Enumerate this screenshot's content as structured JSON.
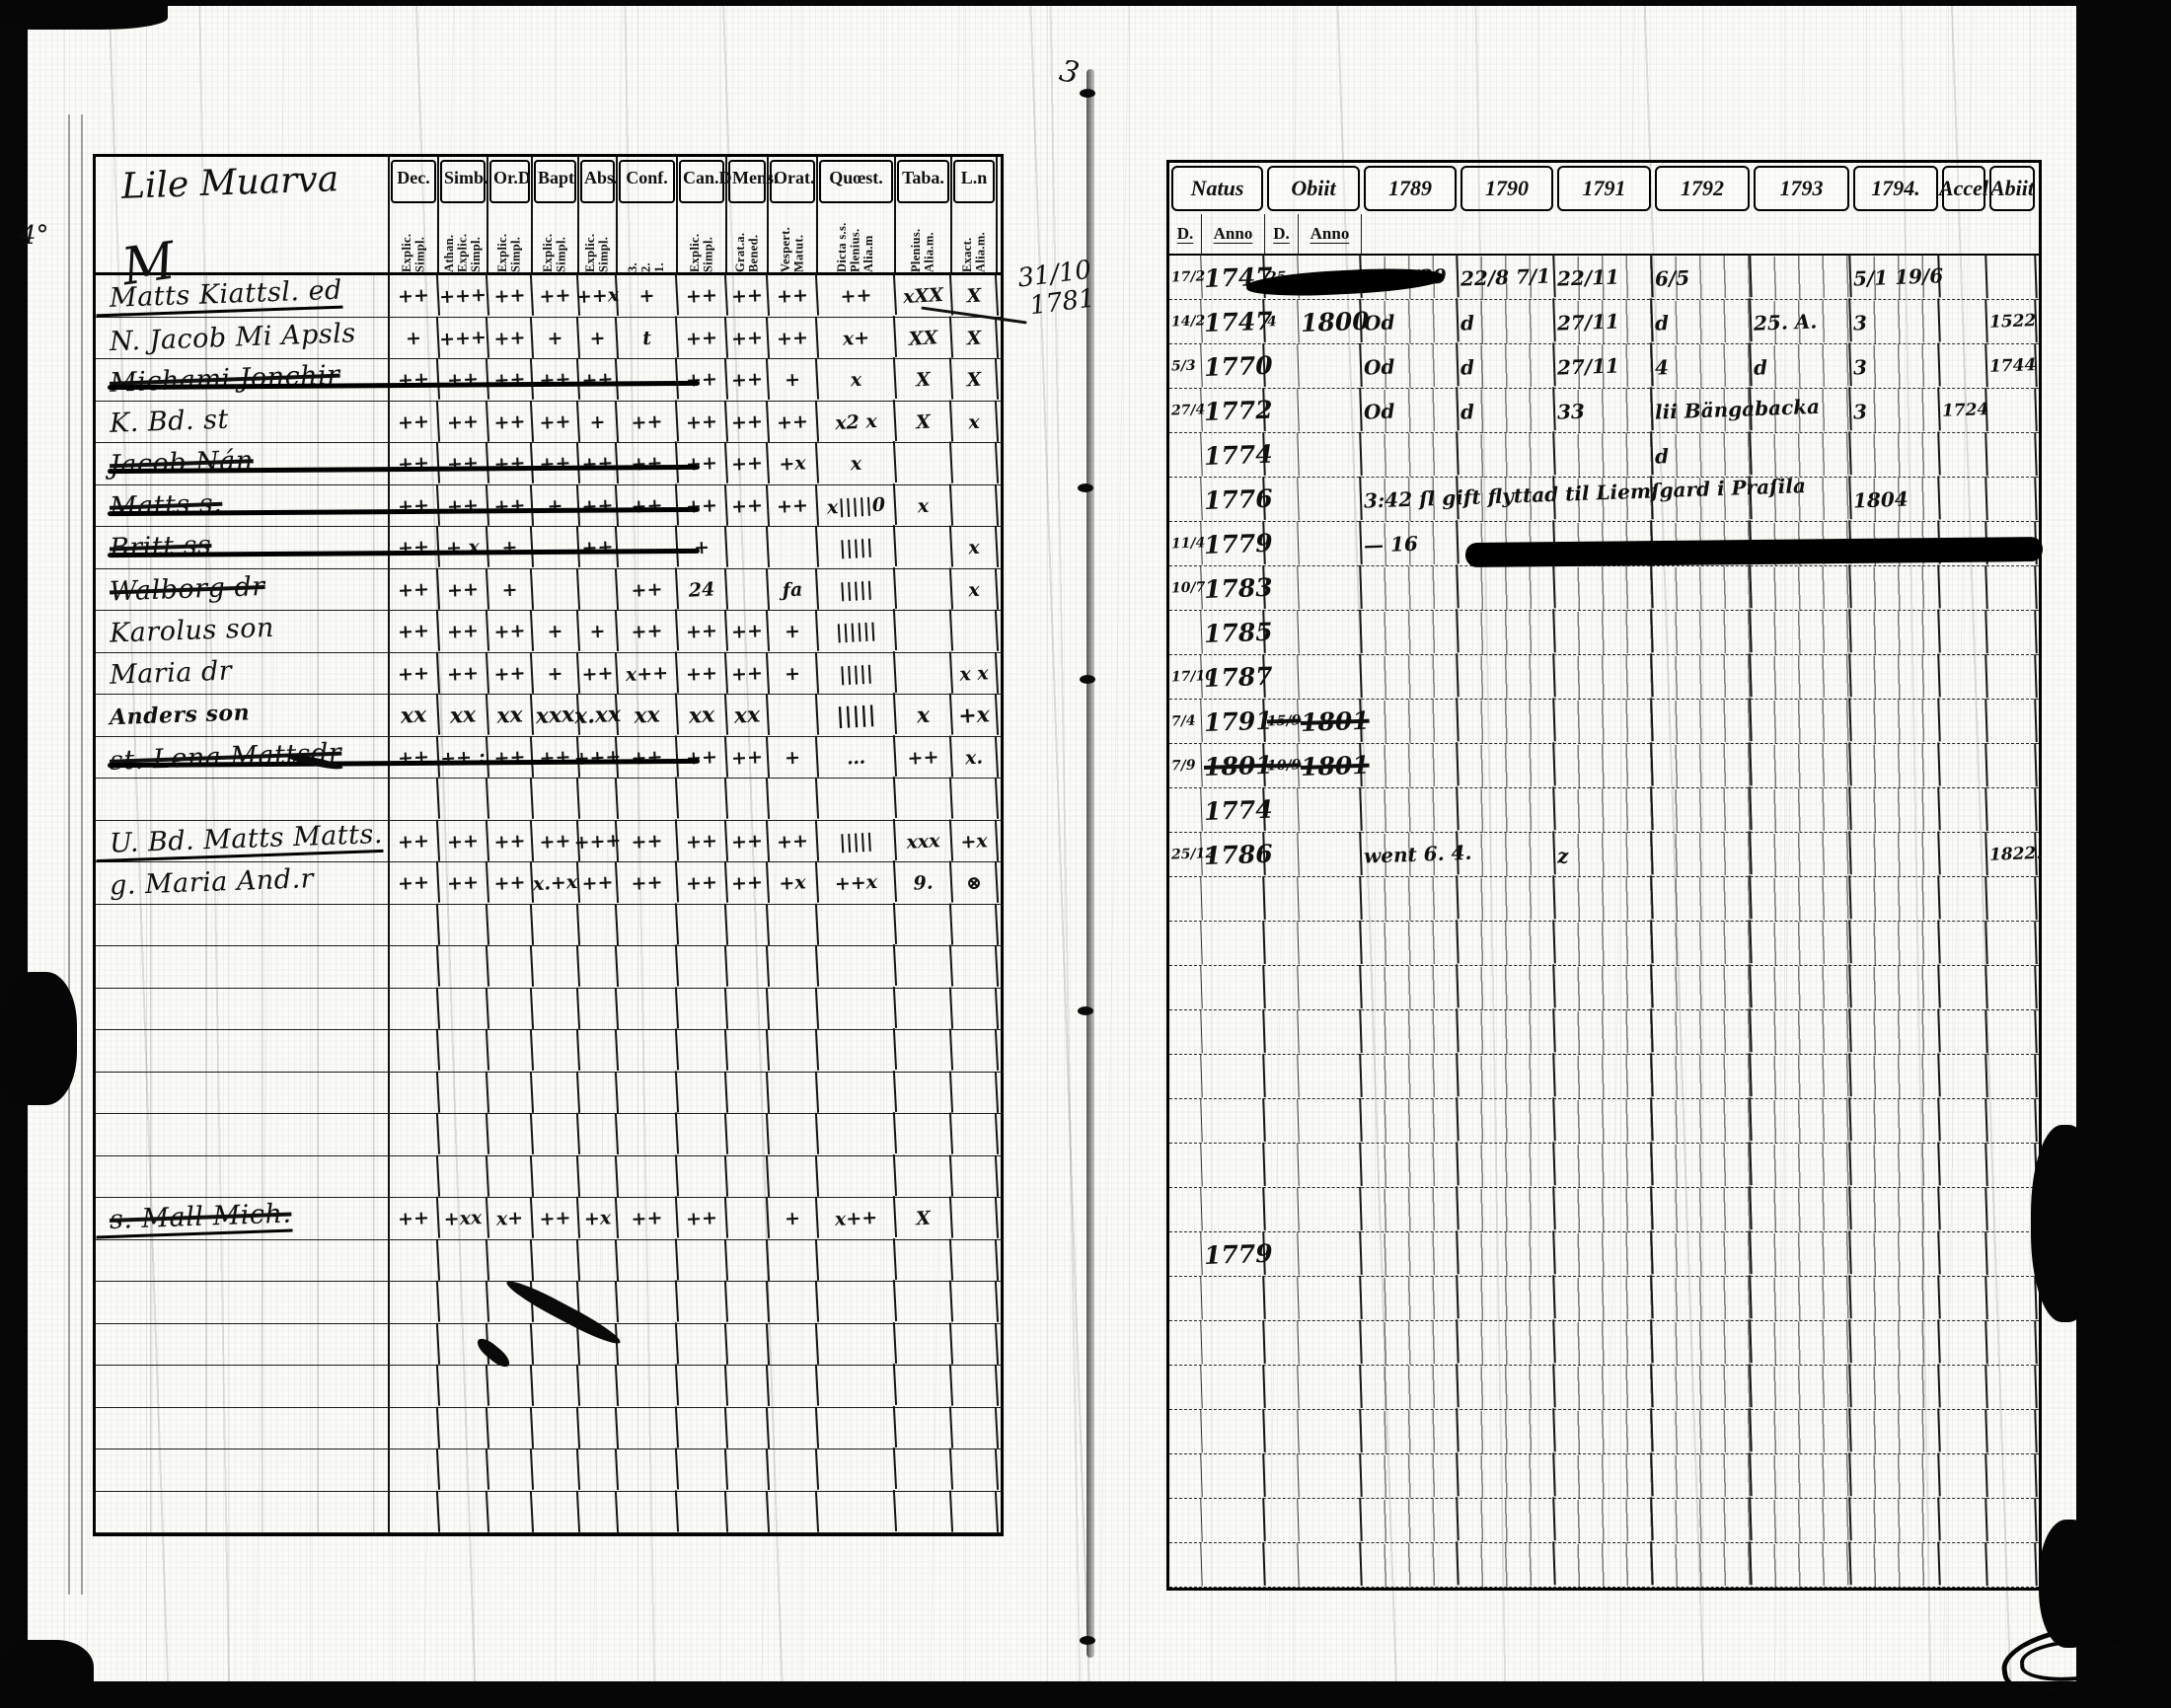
{
  "document": {
    "gutter_top_mark": "3",
    "gutter_note_line1": "31/10",
    "gutter_note_line2": "1781",
    "left_margin_note": "4°"
  },
  "left_page": {
    "title": "Lile Muarva",
    "flourish": "M",
    "columns": [
      {
        "label": "Dec.",
        "sub": "Explic.\nSimpl."
      },
      {
        "label": "Simb.",
        "sub": "Athan.\nExplic.\nSimpl."
      },
      {
        "label": "Or.D",
        "sub": "Explic.\nSimpl."
      },
      {
        "label": "Bapt",
        "sub": "Explic.\nSimpl."
      },
      {
        "label": "Abs.",
        "sub": "Explic.\nSimpl."
      },
      {
        "label": "Conf.",
        "sub": "3.\n2.\n1."
      },
      {
        "label": "Can.D",
        "sub": "Explic.\nSimpl."
      },
      {
        "label": "Mens.",
        "sub": "Grat.a.\nBened."
      },
      {
        "label": "Orat.",
        "sub": "Vespert.\nMatut."
      },
      {
        "label": "Quœst.",
        "sub": "Dicta s.s.\nPlenius.\nAlia.m"
      },
      {
        "label": "Taba.",
        "sub": "Plenius.\nAlia.m."
      },
      {
        "label": "L.n",
        "sub": "Exact.\nAlia.m."
      }
    ],
    "rows": [
      {
        "name": "Matts Kiattsl. ed",
        "underlined": true,
        "cells": [
          "++",
          "+++",
          "++",
          "++",
          "++x",
          "+",
          "++",
          "++",
          "++",
          "++",
          "xXX",
          "X"
        ]
      },
      {
        "name": "N. Jacob Mi Apsls",
        "cells": [
          "+",
          "+++",
          "++",
          "+",
          "+",
          "t",
          "++",
          "++",
          "++",
          "x+",
          "XX",
          "X"
        ]
      },
      {
        "name": "Michami Jonchir",
        "struck": true,
        "strikeLong": true,
        "cells": [
          "++",
          "++",
          "++",
          "++",
          "++",
          "",
          "++",
          "++",
          "+",
          "x",
          "X",
          "X"
        ]
      },
      {
        "name": "K. Bd. st",
        "cells": [
          "++",
          "++",
          "++",
          "++",
          "+",
          "++",
          "++",
          "++",
          "++",
          "x2 x",
          "X",
          "x"
        ]
      },
      {
        "name": "Jacob Nán",
        "struck": true,
        "strikeLong": true,
        "cells": [
          "++",
          "++",
          "++",
          "++",
          "++",
          "++",
          "++",
          "++",
          "+x",
          "x",
          "",
          ""
        ]
      },
      {
        "name": "Matts s.",
        "struck": true,
        "strikeLong": true,
        "cells": [
          "++",
          "++",
          "++",
          "+",
          "++",
          "++",
          "++",
          "++",
          "++",
          "x|||||0",
          "x",
          ""
        ]
      },
      {
        "name": "Britt ss",
        "struck": true,
        "strikeLong": true,
        "cells": [
          "++",
          "+ x",
          "+",
          "",
          "++",
          "",
          "+",
          "",
          "",
          "|||||",
          "",
          "x"
        ]
      },
      {
        "name": "Walborg dr",
        "struck": true,
        "cells": [
          "++",
          "++",
          "+",
          "",
          "",
          "++",
          "24",
          "",
          "ƒa",
          "|||||",
          "",
          "x"
        ]
      },
      {
        "name": "Karolus son",
        "cells": [
          "++",
          "++",
          "++",
          "+",
          "+",
          "++",
          "++",
          "++",
          "+",
          "||||||",
          "",
          ""
        ]
      },
      {
        "name": "Maria dr",
        "cells": [
          "++",
          "++",
          "++",
          "+",
          "++",
          "x++",
          "++",
          "++",
          "+",
          "|||||",
          "",
          "x x"
        ]
      },
      {
        "name": "Anders son",
        "bold": true,
        "cells": [
          "xx",
          "xx",
          "xx",
          "xxx",
          "x.xx",
          "xx",
          "xx",
          "xx",
          "",
          "|||||",
          "x",
          "+x"
        ]
      },
      {
        "name": "st. Lena Mattsdr",
        "struck": true,
        "strikeLong": true,
        "cells": [
          "++",
          "++ :",
          "++",
          "++",
          "+++",
          "++",
          "++",
          "++",
          "+",
          "…",
          "++",
          "x."
        ]
      },
      {
        "name": "",
        "cells": [
          "",
          "",
          "",
          "",
          "",
          "",
          "",
          "",
          "",
          "",
          "",
          ""
        ]
      },
      {
        "name": "U. Bd. Matts Matts.",
        "underlined": true,
        "cells": [
          "++",
          "++",
          "++",
          "++",
          "+++",
          "++",
          "++",
          "++",
          "++",
          "|||||",
          "xxx",
          "+x"
        ]
      },
      {
        "name": "g. Maria And.r",
        "cells": [
          "++",
          "++",
          "++",
          "x.+x",
          "++",
          "++",
          "++",
          "++",
          "+x",
          "++x",
          "9.",
          "⊗"
        ]
      },
      {
        "name": "",
        "cells": [
          "",
          "",
          "",
          "",
          "",
          "",
          "",
          "",
          "",
          "",
          "",
          ""
        ]
      },
      {
        "name": "",
        "cells": [
          "",
          "",
          "",
          "",
          "",
          "",
          "",
          "",
          "",
          "",
          "",
          ""
        ]
      },
      {
        "name": "",
        "cells": [
          "",
          "",
          "",
          "",
          "",
          "",
          "",
          "",
          "",
          "",
          "",
          ""
        ]
      },
      {
        "name": "",
        "cells": [
          "",
          "",
          "",
          "",
          "",
          "",
          "",
          "",
          "",
          "",
          "",
          ""
        ]
      },
      {
        "name": "",
        "cells": [
          "",
          "",
          "",
          "",
          "",
          "",
          "",
          "",
          "",
          "",
          "",
          ""
        ]
      },
      {
        "name": "",
        "cells": [
          "",
          "",
          "",
          "",
          "",
          "",
          "",
          "",
          "",
          "",
          "",
          ""
        ]
      },
      {
        "name": "",
        "cells": [
          "",
          "",
          "",
          "",
          "",
          "",
          "",
          "",
          "",
          "",
          "",
          ""
        ]
      },
      {
        "name": "s. Mall Mich.",
        "struck": true,
        "underlined": true,
        "cells": [
          "++",
          "+xx",
          "x+",
          "++",
          "+x",
          "++",
          "++",
          "",
          "+",
          "x++",
          "X",
          ""
        ]
      },
      {
        "name": "",
        "cells": [
          "",
          "",
          "",
          "",
          "",
          "",
          "",
          "",
          "",
          "",
          "",
          ""
        ]
      },
      {
        "name": "",
        "cells": [
          "",
          "",
          "",
          "",
          "",
          "",
          "",
          "",
          "",
          "",
          "",
          ""
        ]
      },
      {
        "name": "",
        "cells": [
          "",
          "",
          "",
          "",
          "",
          "",
          "",
          "",
          "",
          "",
          "",
          ""
        ]
      },
      {
        "name": "",
        "cells": [
          "",
          "",
          "",
          "",
          "",
          "",
          "",
          "",
          "",
          "",
          "",
          ""
        ]
      },
      {
        "name": "",
        "cells": [
          "",
          "",
          "",
          "",
          "",
          "",
          "",
          "",
          "",
          "",
          "",
          ""
        ]
      },
      {
        "name": "",
        "cells": [
          "",
          "",
          "",
          "",
          "",
          "",
          "",
          "",
          "",
          "",
          "",
          ""
        ]
      },
      {
        "name": "",
        "cells": [
          "",
          "",
          "",
          "",
          "",
          "",
          "",
          "",
          "",
          "",
          "",
          ""
        ]
      }
    ]
  },
  "right_page": {
    "header_groups": [
      {
        "label": "Natus",
        "span": 2
      },
      {
        "label": "Obiit",
        "span": 2
      },
      {
        "label": "1789"
      },
      {
        "label": "1790"
      },
      {
        "label": "1791"
      },
      {
        "label": "1792"
      },
      {
        "label": "1793"
      },
      {
        "label": "1794."
      },
      {
        "label": "Accel"
      },
      {
        "label": "Abiit"
      }
    ],
    "sub_headers": [
      {
        "label": "D."
      },
      {
        "label": "Anno"
      },
      {
        "label": "D."
      },
      {
        "label": "Anno"
      }
    ],
    "rows": [
      {
        "redactObiit": true,
        "cells": [
          "17/2",
          "1747",
          "25",
          "",
          "4 90/39",
          "22/8 7/1",
          "22/11",
          "6/5",
          "",
          "5/1 19/6",
          "",
          ""
        ]
      },
      {
        "cells": [
          "14/2",
          "1747",
          "4",
          "1800",
          "Od",
          "d",
          "27/11",
          "d",
          "25. A.",
          "3",
          "",
          "1522"
        ]
      },
      {
        "cells": [
          "5/3",
          "1770",
          "",
          "",
          "Od",
          "d",
          "27/11",
          "4",
          "d",
          "3",
          "",
          "1744"
        ]
      },
      {
        "cells": [
          "27/4",
          "1772",
          "",
          "",
          "Od",
          "d",
          "33",
          "lii Bängabacka",
          "",
          "3",
          "1724",
          ""
        ]
      },
      {
        "cells": [
          "",
          "1774",
          "",
          "",
          "",
          "",
          "",
          "d",
          "",
          "",
          "",
          ""
        ]
      },
      {
        "cells": [
          "",
          "1776",
          "",
          "",
          "3:42 ſl gift flyttad til Liemſgard i Praſila",
          "",
          "",
          "",
          "",
          "1804",
          "",
          ""
        ]
      },
      {
        "redactYears": true,
        "cells": [
          "11/4",
          "1779",
          "",
          "",
          "— 16",
          "",
          "",
          "ga",
          "",
          "",
          "",
          ""
        ]
      },
      {
        "cells": [
          "10/7",
          "1783",
          "",
          "",
          "",
          "",
          "",
          "",
          "",
          "",
          "",
          ""
        ]
      },
      {
        "cells": [
          "",
          "1785",
          "",
          "",
          "",
          "",
          "",
          "",
          "",
          "",
          "",
          ""
        ]
      },
      {
        "cells": [
          "17/10",
          "1787",
          "",
          "",
          "",
          "",
          "",
          "",
          "",
          "",
          "",
          ""
        ]
      },
      {
        "strikeObiit": true,
        "cells": [
          "7/4",
          "1791",
          "15/9",
          "1801",
          "",
          "",
          "",
          "",
          "",
          "",
          "",
          ""
        ]
      },
      {
        "strikeObiit": true,
        "strikeAnno": true,
        "cells": [
          "7/9",
          "1801",
          "10/9",
          "1801",
          "",
          "",
          "",
          "",
          "",
          "",
          "",
          ""
        ]
      },
      {
        "cells": [
          "",
          "1774",
          "",
          "",
          "",
          "",
          "",
          "",
          "",
          "",
          "",
          ""
        ]
      },
      {
        "cells": [
          "25/12",
          "1786",
          "",
          "",
          "went 6. 4.",
          "",
          "z",
          "",
          "",
          "",
          "",
          "1822."
        ]
      },
      {
        "cells": [
          "",
          "",
          "",
          "",
          "",
          "",
          "",
          "",
          "",
          "",
          "",
          ""
        ]
      },
      {
        "cells": [
          "",
          "",
          "",
          "",
          "",
          "",
          "",
          "",
          "",
          "",
          "",
          ""
        ]
      },
      {
        "cells": [
          "",
          "",
          "",
          "",
          "",
          "",
          "",
          "",
          "",
          "",
          "",
          ""
        ]
      },
      {
        "cells": [
          "",
          "",
          "",
          "",
          "",
          "",
          "",
          "",
          "",
          "",
          "",
          ""
        ]
      },
      {
        "cells": [
          "",
          "",
          "",
          "",
          "",
          "",
          "",
          "",
          "",
          "",
          "",
          ""
        ]
      },
      {
        "cells": [
          "",
          "",
          "",
          "",
          "",
          "",
          "",
          "",
          "",
          "",
          "",
          ""
        ]
      },
      {
        "cells": [
          "",
          "",
          "",
          "",
          "",
          "",
          "",
          "",
          "",
          "",
          "",
          ""
        ]
      },
      {
        "cells": [
          "",
          "",
          "",
          "",
          "",
          "",
          "",
          "",
          "",
          "",
          "",
          ""
        ]
      },
      {
        "cells": [
          "",
          "1779",
          "",
          "",
          "",
          "",
          "",
          "",
          "",
          "",
          "",
          ""
        ]
      },
      {
        "cells": [
          "",
          "",
          "",
          "",
          "",
          "",
          "",
          "",
          "",
          "",
          "",
          ""
        ]
      },
      {
        "cells": [
          "",
          "",
          "",
          "",
          "",
          "",
          "",
          "",
          "",
          "",
          "",
          ""
        ]
      },
      {
        "cells": [
          "",
          "",
          "",
          "",
          "",
          "",
          "",
          "",
          "",
          "",
          "",
          ""
        ]
      },
      {
        "cells": [
          "",
          "",
          "",
          "",
          "",
          "",
          "",
          "",
          "",
          "",
          "",
          ""
        ]
      },
      {
        "cells": [
          "",
          "",
          "",
          "",
          "",
          "",
          "",
          "",
          "",
          "",
          "",
          ""
        ]
      },
      {
        "cells": [
          "",
          "",
          "",
          "",
          "",
          "",
          "",
          "",
          "",
          "",
          "",
          ""
        ]
      },
      {
        "cells": [
          "",
          "",
          "",
          "",
          "",
          "",
          "",
          "",
          "",
          "",
          "",
          ""
        ]
      }
    ]
  }
}
